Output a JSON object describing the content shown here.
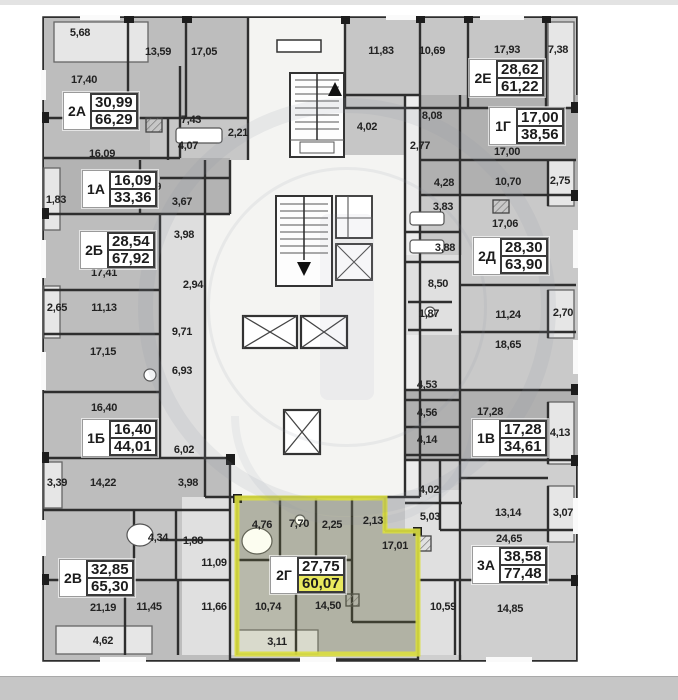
{
  "plan": {
    "highlight_stroke": "#dce040",
    "highlight_fill_value": "#e9e95e",
    "watermark_present": true,
    "stairs": {
      "up_arrow": "▲",
      "down_arrow": "▼"
    },
    "apartments": [
      {
        "id": "2А",
        "living": "30,99",
        "total": "66,29",
        "x": 63,
        "y": 92,
        "highlighted": false
      },
      {
        "id": "1А",
        "living": "16,09",
        "total": "33,36",
        "x": 82,
        "y": 170,
        "highlighted": false
      },
      {
        "id": "2Б",
        "living": "28,54",
        "total": "67,92",
        "x": 80,
        "y": 231,
        "highlighted": false
      },
      {
        "id": "1Б",
        "living": "16,40",
        "total": "44,01",
        "x": 82,
        "y": 419,
        "highlighted": false
      },
      {
        "id": "2В",
        "living": "32,85",
        "total": "65,30",
        "x": 59,
        "y": 559,
        "highlighted": false
      },
      {
        "id": "2Г",
        "living": "27,75",
        "total": "60,07",
        "x": 270,
        "y": 556,
        "highlighted": true
      },
      {
        "id": "3А",
        "living": "38,58",
        "total": "77,48",
        "x": 472,
        "y": 546,
        "highlighted": false
      },
      {
        "id": "1В",
        "living": "17,28",
        "total": "34,61",
        "x": 472,
        "y": 419,
        "highlighted": false
      },
      {
        "id": "2Д",
        "living": "28,30",
        "total": "63,90",
        "x": 473,
        "y": 237,
        "highlighted": false
      },
      {
        "id": "1Г",
        "living": "17,00",
        "total": "38,56",
        "x": 489,
        "y": 107,
        "highlighted": false
      },
      {
        "id": "2Е",
        "living": "28,62",
        "total": "61,22",
        "x": 469,
        "y": 59,
        "highlighted": false
      }
    ],
    "room_labels": [
      {
        "t": "5,68",
        "x": 80,
        "y": 33
      },
      {
        "t": "13,59",
        "x": 158,
        "y": 52
      },
      {
        "t": "17,05",
        "x": 204,
        "y": 52
      },
      {
        "t": "17,40",
        "x": 84,
        "y": 80
      },
      {
        "t": "7,43",
        "x": 191,
        "y": 120
      },
      {
        "t": "16,09",
        "x": 102,
        "y": 154
      },
      {
        "t": "4,07",
        "x": 188,
        "y": 146
      },
      {
        "t": "7,79",
        "x": 151,
        "y": 187
      },
      {
        "t": "1,83",
        "x": 56,
        "y": 200
      },
      {
        "t": "3,67",
        "x": 182,
        "y": 202
      },
      {
        "t": "2,21",
        "x": 238,
        "y": 133
      },
      {
        "t": "4,02",
        "x": 367,
        "y": 127
      },
      {
        "t": "11,83",
        "x": 381,
        "y": 51
      },
      {
        "t": "10,69",
        "x": 432,
        "y": 51
      },
      {
        "t": "17,93",
        "x": 507,
        "y": 50
      },
      {
        "t": "7,38",
        "x": 558,
        "y": 50
      },
      {
        "t": "8,08",
        "x": 432,
        "y": 116
      },
      {
        "t": "2,77",
        "x": 420,
        "y": 146
      },
      {
        "t": "17,00",
        "x": 507,
        "y": 152
      },
      {
        "t": "4,28",
        "x": 444,
        "y": 183
      },
      {
        "t": "10,70",
        "x": 508,
        "y": 182
      },
      {
        "t": "2,75",
        "x": 560,
        "y": 181
      },
      {
        "t": "3,83",
        "x": 443,
        "y": 207
      },
      {
        "t": "3,88",
        "x": 445,
        "y": 248
      },
      {
        "t": "3,98",
        "x": 184,
        "y": 235
      },
      {
        "t": "17,41",
        "x": 104,
        "y": 273
      },
      {
        "t": "2,94",
        "x": 193,
        "y": 285
      },
      {
        "t": "2,65",
        "x": 57,
        "y": 308
      },
      {
        "t": "11,13",
        "x": 104,
        "y": 308
      },
      {
        "t": "9,71",
        "x": 182,
        "y": 332
      },
      {
        "t": "17,15",
        "x": 103,
        "y": 352
      },
      {
        "t": "6,93",
        "x": 182,
        "y": 371
      },
      {
        "t": "16,40",
        "x": 104,
        "y": 408
      },
      {
        "t": "6,02",
        "x": 184,
        "y": 450
      },
      {
        "t": "17,06",
        "x": 505,
        "y": 224
      },
      {
        "t": "8,50",
        "x": 438,
        "y": 284
      },
      {
        "t": "1,87",
        "x": 429,
        "y": 314
      },
      {
        "t": "11,24",
        "x": 508,
        "y": 315
      },
      {
        "t": "2,70",
        "x": 563,
        "y": 313
      },
      {
        "t": "18,65",
        "x": 508,
        "y": 345
      },
      {
        "t": "4,53",
        "x": 427,
        "y": 385
      },
      {
        "t": "4,56",
        "x": 427,
        "y": 413
      },
      {
        "t": "4,14",
        "x": 427,
        "y": 440
      },
      {
        "t": "17,28",
        "x": 490,
        "y": 412
      },
      {
        "t": "4,13",
        "x": 560,
        "y": 433
      },
      {
        "t": "4,02",
        "x": 429,
        "y": 490
      },
      {
        "t": "5,03",
        "x": 430,
        "y": 517
      },
      {
        "t": "3,39",
        "x": 57,
        "y": 483
      },
      {
        "t": "14,22",
        "x": 103,
        "y": 483
      },
      {
        "t": "3,98",
        "x": 188,
        "y": 483
      },
      {
        "t": "4,34",
        "x": 158,
        "y": 538
      },
      {
        "t": "1,88",
        "x": 193,
        "y": 541
      },
      {
        "t": "11,09",
        "x": 214,
        "y": 563
      },
      {
        "t": "21,19",
        "x": 103,
        "y": 608
      },
      {
        "t": "11,45",
        "x": 149,
        "y": 607
      },
      {
        "t": "11,66",
        "x": 214,
        "y": 607
      },
      {
        "t": "4,62",
        "x": 103,
        "y": 641
      },
      {
        "t": "4,76",
        "x": 262,
        "y": 525
      },
      {
        "t": "7,70",
        "x": 299,
        "y": 524
      },
      {
        "t": "2,25",
        "x": 332,
        "y": 525
      },
      {
        "t": "2,13",
        "x": 373,
        "y": 521
      },
      {
        "t": "17,01",
        "x": 395,
        "y": 546
      },
      {
        "t": "10,74",
        "x": 268,
        "y": 607
      },
      {
        "t": "14,50",
        "x": 328,
        "y": 606
      },
      {
        "t": "3,11",
        "x": 277,
        "y": 642
      },
      {
        "t": "10,59",
        "x": 443,
        "y": 607
      },
      {
        "t": "13,14",
        "x": 508,
        "y": 513
      },
      {
        "t": "3,07",
        "x": 563,
        "y": 513
      },
      {
        "t": "24,65",
        "x": 509,
        "y": 539
      },
      {
        "t": "14,85",
        "x": 510,
        "y": 609
      }
    ]
  }
}
